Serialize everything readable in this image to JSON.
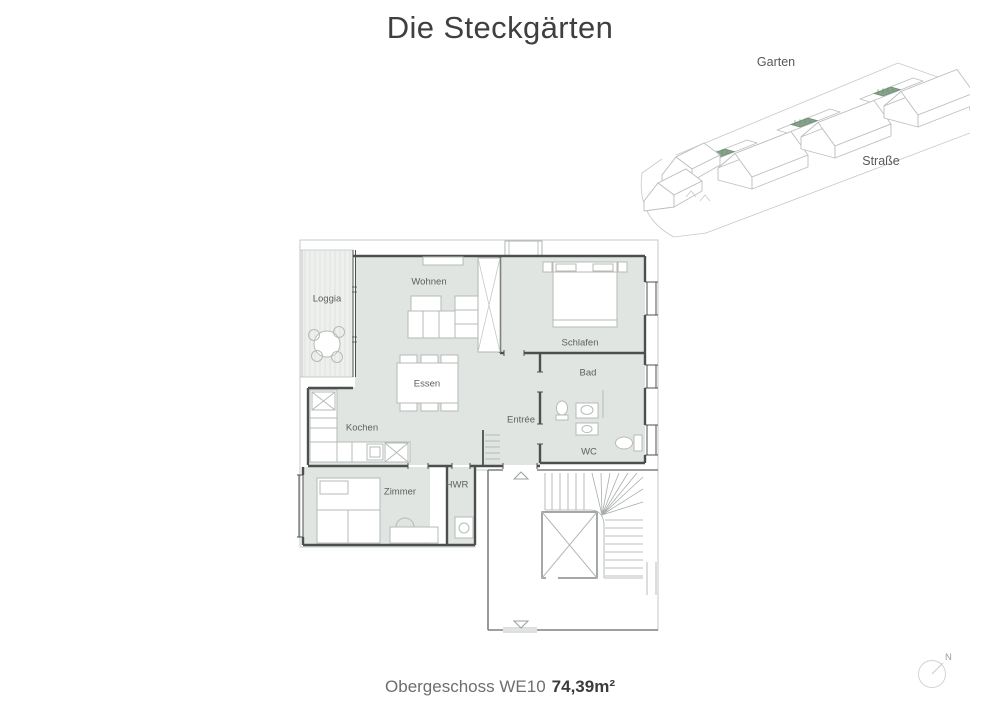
{
  "title": "Die Steckgärten",
  "site_plan": {
    "garten_label": "Garten",
    "strasse_label": "Straße",
    "highlight_color": "#87a28b"
  },
  "floor_plan": {
    "fill_color": "#e0e5e2",
    "rooms": [
      {
        "id": "loggia",
        "label": "Loggia"
      },
      {
        "id": "wohnen",
        "label": "Wohnen"
      },
      {
        "id": "schlafen",
        "label": "Schlafen"
      },
      {
        "id": "essen",
        "label": "Essen"
      },
      {
        "id": "bad",
        "label": "Bad"
      },
      {
        "id": "entree",
        "label": "Entrée"
      },
      {
        "id": "kochen",
        "label": "Kochen"
      },
      {
        "id": "wc",
        "label": "WC"
      },
      {
        "id": "zimmer",
        "label": "Zimmer"
      },
      {
        "id": "hwr",
        "label": "HWR"
      }
    ]
  },
  "caption": {
    "prefix": "Obergeschoss WE10",
    "area": "74,39m²"
  },
  "compass": {
    "label": "N"
  }
}
